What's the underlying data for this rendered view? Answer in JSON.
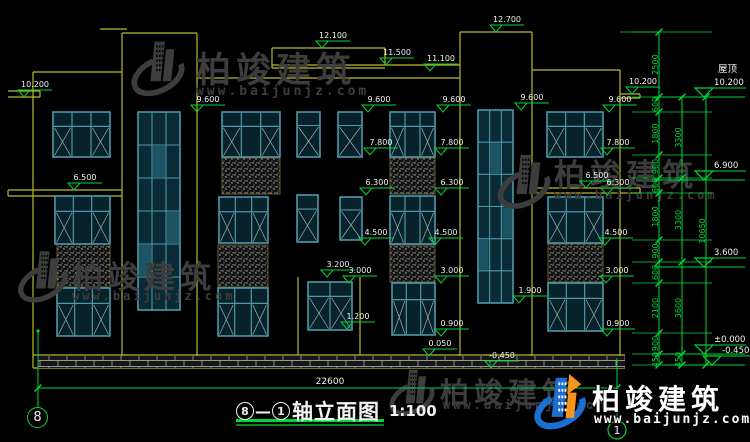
{
  "colors": {
    "bg": "#000000",
    "wall": "#b9b92a",
    "frame": "#4e98a8",
    "frame_dark": "#2a5f6e",
    "glass": "#08222b",
    "glass_lite": "#2e7d95",
    "green": "#00d837",
    "white": "#eef2ee",
    "watermark": "#3d3d3d",
    "spandrel_border": "#7d6c38",
    "logo_blue": "#1b6fd0",
    "logo_orange": "#f7941d"
  },
  "annotations": {
    "small_levels": [
      {
        "label": "12.100",
        "x": 322,
        "y": 48
      },
      {
        "label": "11.500",
        "x": 386,
        "y": 65
      },
      {
        "label": "11.100",
        "x": 430,
        "y": 71
      },
      {
        "label": "12.700",
        "x": 496,
        "y": 32
      },
      {
        "label": "10.200",
        "x": 24,
        "y": 97
      },
      {
        "label": "10.200",
        "x": 632,
        "y": 94
      },
      {
        "label": "9.600",
        "x": 197,
        "y": 112
      },
      {
        "label": "9.600",
        "x": 368,
        "y": 112
      },
      {
        "label": "9.600",
        "x": 443,
        "y": 112
      },
      {
        "label": "9.600",
        "x": 521,
        "y": 110
      },
      {
        "label": "9.600",
        "x": 609,
        "y": 112
      },
      {
        "label": "7.800",
        "x": 370,
        "y": 155
      },
      {
        "label": "7.800",
        "x": 441,
        "y": 155
      },
      {
        "label": "7.800",
        "x": 607,
        "y": 155
      },
      {
        "label": "6.500",
        "x": 74,
        "y": 190
      },
      {
        "label": "6.500",
        "x": 586,
        "y": 188
      },
      {
        "label": "6.300",
        "x": 366,
        "y": 195
      },
      {
        "label": "6.300",
        "x": 441,
        "y": 195
      },
      {
        "label": "6.300",
        "x": 607,
        "y": 195
      },
      {
        "label": "4.500",
        "x": 365,
        "y": 245
      },
      {
        "label": "4.500",
        "x": 435,
        "y": 245
      },
      {
        "label": "4.500",
        "x": 605,
        "y": 245
      },
      {
        "label": "3.200",
        "x": 327,
        "y": 277
      },
      {
        "label": "3.000",
        "x": 349,
        "y": 283
      },
      {
        "label": "3.000",
        "x": 441,
        "y": 283
      },
      {
        "label": "3.000",
        "x": 606,
        "y": 283
      },
      {
        "label": "1.900",
        "x": 519,
        "y": 303
      },
      {
        "label": "1.200",
        "x": 347,
        "y": 329
      },
      {
        "label": "0.900",
        "x": 441,
        "y": 336
      },
      {
        "label": "0.900",
        "x": 607,
        "y": 336
      },
      {
        "label": "0.050",
        "x": 429,
        "y": 356
      },
      {
        "label": "-0.450",
        "x": 491,
        "y": 368
      }
    ],
    "big_levels": [
      {
        "label": "10.200",
        "prefix": "屋顶",
        "x": 704,
        "y": 97
      },
      {
        "label": "6.900",
        "x": 704,
        "y": 180
      },
      {
        "label": "3.600",
        "x": 704,
        "y": 267
      },
      {
        "label": "±0.000",
        "x": 704,
        "y": 354
      },
      {
        "label": "-0.450",
        "x": 712,
        "y": 365
      }
    ]
  },
  "dim_chains": [
    {
      "x": 659,
      "ticks": [
        32,
        97,
        112,
        155,
        178,
        193,
        240,
        262,
        283,
        333,
        354,
        365
      ],
      "labels": [
        "2500",
        "600",
        "1800",
        "900",
        "600",
        "1800",
        "900",
        "600",
        "2100",
        "900",
        "450"
      ]
    },
    {
      "x": 682,
      "ticks": [
        97,
        178,
        262,
        354,
        365
      ],
      "labels": [
        "3300",
        "3300",
        "3600",
        "450"
      ]
    },
    {
      "x": 706,
      "ticks": [
        97,
        365
      ],
      "labels": [
        "10650"
      ]
    }
  ],
  "extension_levels": [
    32,
    97,
    112,
    155,
    178,
    193,
    240,
    262,
    283,
    333,
    354,
    365
  ],
  "bottom_dim": {
    "label": "22600",
    "x1": 38,
    "x2": 617,
    "y": 388
  },
  "axis_bubble_left": {
    "label": "8"
  },
  "axis_bubble_right": {
    "label": "1",
    "x": 617,
    "y": 430,
    "r": 9,
    "line_y1": 358
  },
  "title": {
    "bubble_left": "8",
    "dash": "—",
    "bubble_right": "1",
    "name": "轴立面图",
    "scale": "1:100"
  },
  "watermarks": {
    "text": "柏竣建筑",
    "url": "www.baijunjz.com",
    "gray": [
      {
        "x": 126,
        "y": 36,
        "logo_w": 64,
        "logo_h": 66,
        "text_dx": 70,
        "text_dy": 6,
        "text_size": 35,
        "url_dx": 70,
        "url_dy": 48,
        "url_size": 13
      },
      {
        "x": 16,
        "y": 246,
        "logo_w": 54,
        "logo_h": 62,
        "text_dx": 56,
        "text_dy": 6,
        "text_size": 31,
        "url_dx": 56,
        "url_dy": 43,
        "url_size": 12
      },
      {
        "x": 496,
        "y": 144,
        "logo_w": 56,
        "logo_h": 76,
        "text_dx": 58,
        "text_dy": 6,
        "text_size": 31,
        "url_dx": 58,
        "url_dy": 44,
        "url_size": 12
      },
      {
        "x": 388,
        "y": 364,
        "logo_w": 48,
        "logo_h": 58,
        "text_dx": 52,
        "text_dy": 6,
        "text_size": 29,
        "url_dx": 55,
        "url_dy": 34,
        "url_size": 12
      }
    ],
    "brand": {
      "x": 534,
      "y": 372,
      "logo_w": 56,
      "logo_h": 60,
      "text_dx": 58,
      "text_dy": 6,
      "text_size": 28,
      "url_dx": 60,
      "url_dy": 40,
      "url_size": 13
    }
  },
  "structure": {
    "wall_lines": [
      [
        33,
        72,
        33,
        368
      ],
      [
        122,
        33,
        122,
        368
      ],
      [
        197,
        33,
        197,
        368
      ],
      [
        272,
        48,
        272,
        68
      ],
      [
        385,
        48,
        385,
        65
      ],
      [
        460,
        32,
        460,
        368
      ],
      [
        532,
        32,
        532,
        368
      ],
      [
        620,
        70,
        620,
        368
      ],
      [
        298,
        277,
        298,
        355
      ],
      [
        360,
        277,
        360,
        355
      ],
      [
        640,
        94,
        640,
        98
      ],
      [
        8,
        190,
        8,
        196
      ],
      [
        640,
        188,
        640,
        193
      ],
      [
        40,
        91,
        40,
        97
      ],
      [
        100,
        29,
        127,
        29
      ],
      [
        122,
        33,
        197,
        33
      ],
      [
        33,
        72,
        122,
        72
      ],
      [
        197,
        78,
        460,
        78
      ],
      [
        272,
        48,
        385,
        48
      ],
      [
        272,
        65,
        460,
        65
      ],
      [
        272,
        68,
        385,
        68
      ],
      [
        460,
        32,
        532,
        32
      ],
      [
        532,
        70,
        620,
        70
      ],
      [
        620,
        94,
        640,
        94
      ],
      [
        620,
        98,
        640,
        98
      ],
      [
        8,
        91,
        40,
        91
      ],
      [
        8,
        97,
        40,
        97
      ],
      [
        8,
        190,
        122,
        190
      ],
      [
        8,
        196,
        122,
        196
      ],
      [
        535,
        188,
        640,
        188
      ],
      [
        535,
        193,
        640,
        193
      ],
      [
        33,
        355,
        625,
        355
      ],
      [
        33,
        368,
        625,
        368
      ]
    ],
    "windows_bay3": [
      {
        "x": 53,
        "y": 112,
        "w": 57,
        "h": 45
      },
      {
        "x": 222,
        "y": 112,
        "w": 58,
        "h": 45
      },
      {
        "x": 390,
        "y": 112,
        "w": 45,
        "h": 45
      },
      {
        "x": 547,
        "y": 112,
        "w": 56,
        "h": 45
      },
      {
        "x": 55,
        "y": 196,
        "w": 55,
        "h": 48
      },
      {
        "x": 219,
        "y": 197,
        "w": 49,
        "h": 46
      },
      {
        "x": 390,
        "y": 196,
        "w": 45,
        "h": 48
      },
      {
        "x": 548,
        "y": 197,
        "w": 55,
        "h": 46
      },
      {
        "x": 57,
        "y": 288,
        "w": 53,
        "h": 48
      },
      {
        "x": 218,
        "y": 288,
        "w": 50,
        "h": 48
      },
      {
        "x": 392,
        "y": 283,
        "w": 43,
        "h": 52
      },
      {
        "x": 548,
        "y": 283,
        "w": 55,
        "h": 48
      }
    ],
    "windows_narrow": [
      {
        "x": 297,
        "y": 112,
        "w": 23,
        "h": 45
      },
      {
        "x": 338,
        "y": 112,
        "w": 24,
        "h": 45
      },
      {
        "x": 297,
        "y": 195,
        "w": 21,
        "h": 47
      },
      {
        "x": 340,
        "y": 197,
        "w": 22,
        "h": 43
      }
    ],
    "windows_bay2": [
      {
        "x": 308,
        "y": 282,
        "w": 44,
        "h": 48
      }
    ],
    "windows_stair": [
      {
        "x": 138,
        "y": 112,
        "w": 42,
        "h": 198
      },
      {
        "x": 478,
        "y": 110,
        "w": 35,
        "h": 193
      }
    ],
    "spandrels": [
      {
        "x": 222,
        "y": 158,
        "w": 58,
        "h": 36
      },
      {
        "x": 390,
        "y": 158,
        "w": 45,
        "h": 36
      },
      {
        "x": 57,
        "y": 243,
        "w": 53,
        "h": 44
      },
      {
        "x": 218,
        "y": 245,
        "w": 50,
        "h": 42
      },
      {
        "x": 390,
        "y": 245,
        "w": 45,
        "h": 37
      },
      {
        "x": 548,
        "y": 244,
        "w": 55,
        "h": 38
      }
    ],
    "brick_band": {
      "x": 38,
      "y": 356,
      "w": 587,
      "h": 12
    }
  }
}
